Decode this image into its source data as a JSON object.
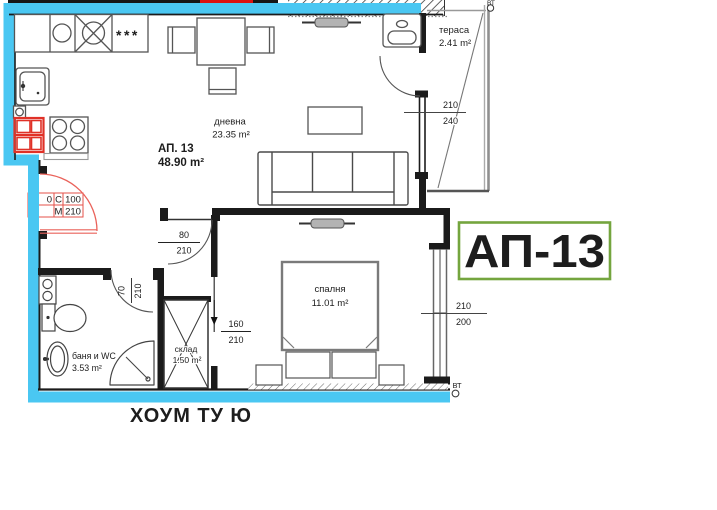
{
  "header": {
    "badge": "АП-13"
  },
  "unit": {
    "label": "АП. 13",
    "area": "48.90 m²"
  },
  "rooms": {
    "living": {
      "name": "дневна",
      "area": "23.35 m²"
    },
    "bedroom": {
      "name": "спалня",
      "area": "11.01 m²"
    },
    "bathroom": {
      "name": "баня и WC",
      "area": "3.53 m²"
    },
    "storage": {
      "name": "склад",
      "area": "1.50 m²"
    },
    "terrace": {
      "name": "тераса",
      "area": "2.41 m²"
    }
  },
  "openings": {
    "hall_door": {
      "w": "80",
      "h": "210"
    },
    "bathroom_door": {
      "w": "70",
      "h": "210"
    },
    "bedroom_door": {
      "w": "160",
      "h": "210"
    },
    "terrace_window": {
      "w": "210",
      "h": "240"
    },
    "bedroom_window": {
      "w": "210",
      "h": "200"
    },
    "entrance_spec": {
      "left_partial": "0",
      "c_label": "C",
      "c_value": "100",
      "m_label": "M",
      "m_value": "210"
    }
  },
  "markers": {
    "vent_top": "ВТ",
    "vent_bottom": "ВТ",
    "kitchen_symbol": "***"
  },
  "watermark": "ХОУМ ТУ Ю",
  "colors": {
    "outline_cyan": "#4ac7f2",
    "accent_red": "#e03127",
    "door_red": "#ea625a",
    "badge_green": "#74a53e",
    "watermark_pink": "#e2898e"
  }
}
